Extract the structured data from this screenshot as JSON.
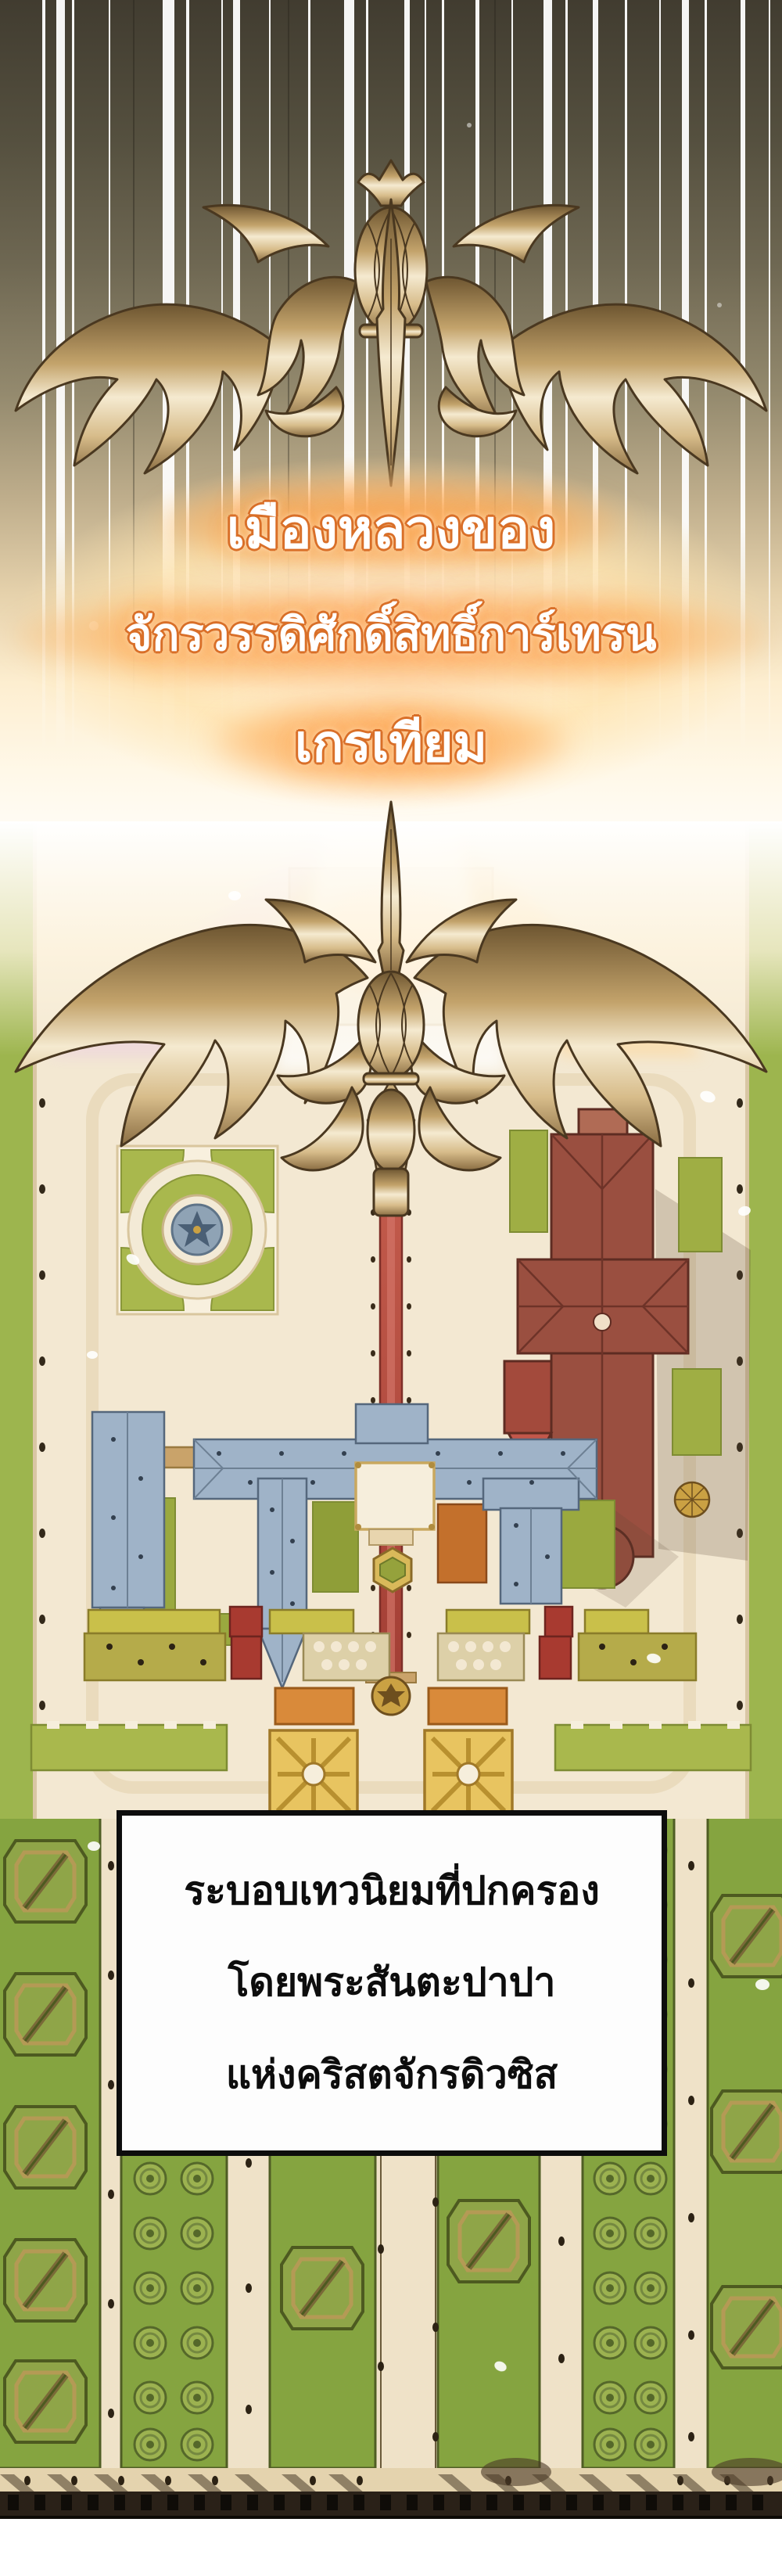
{
  "panel": {
    "type": "webtoon-comic-panel",
    "title": {
      "line1": "เมืองหลวงของ",
      "line2": "จักรวรรดิศักดิ์สิทธิ์การ์เทรน",
      "line3": "เกรเทียม"
    },
    "caption": {
      "line1": "ระบอบเทวนิยมที่ปกครอง",
      "line2": "โดยพระสันตะปาปา",
      "line3": "แห่งคริสตจักรดิวซิส"
    },
    "colors": {
      "title_fill": "#ffffff",
      "title_outline": "#d96f28",
      "title_glow": "#ffb25e",
      "caption_text": "#0d0d0d",
      "caption_box_bg": "#fdfdfd",
      "caption_box_border": "#0d0d0d",
      "sky_dark": "#413c30",
      "speed_line": "#ffffff",
      "gold_light": "#f5ead0",
      "gold_mid": "#c3a36b",
      "gold_dark": "#6e5631",
      "gold_outline": "#4a3820",
      "map_cream": "#f3e8d2",
      "lawn_green": "#9db54e",
      "roof_blue": "#9fb3c8",
      "roof_maroon": "#9a4f40",
      "carpet_red": "#b94f42",
      "stable_yellow": "#c9c04a",
      "parterre_amber": "#e0b54f",
      "hedge_green": "#85a440",
      "wall_dark": "#2a2118"
    }
  }
}
